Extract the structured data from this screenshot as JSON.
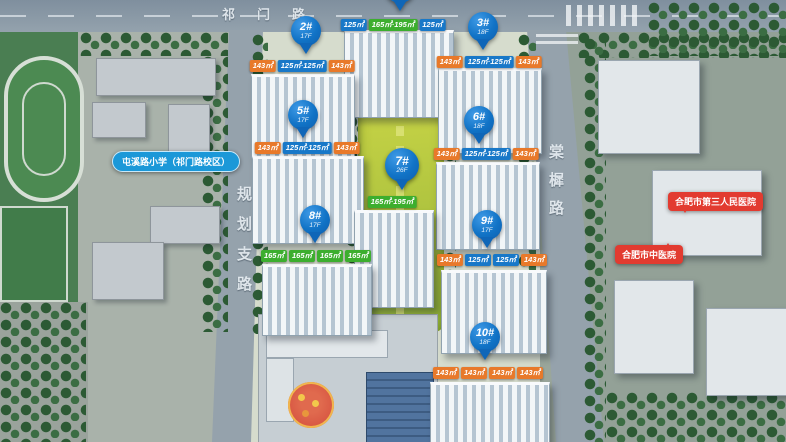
{
  "palette": {
    "pin_blue": "#1173c6",
    "tag_orange": "#e8792a",
    "tag_blue": "#1878c8",
    "tag_green": "#3cae2e",
    "poi_red": "#e23b30",
    "poi_school_blue": "#1b98d8",
    "road_gray": "#95a2ac",
    "park_green": "#aec33f"
  },
  "roads": {
    "top_label": "祁门路",
    "left_label": "规划支路",
    "right_label": "棠樨路"
  },
  "pois": {
    "school": "屯溪路小学（祁门路校区）",
    "hospital_third": "合肥市第三人民医院",
    "hospital_tcm": "合肥市中医院"
  },
  "buildings": [
    {
      "id": "1#",
      "tags": [
        {
          "color": "blue",
          "text": "125㎡"
        },
        {
          "color": "green",
          "text": "165㎡·195㎡"
        },
        {
          "color": "blue",
          "text": "125㎡"
        }
      ]
    },
    {
      "id": "2#",
      "pin": {
        "label": "2#",
        "sub": "17F"
      },
      "tags": [
        {
          "color": "orange",
          "text": "143㎡"
        },
        {
          "color": "blue",
          "text": "125㎡·125㎡"
        },
        {
          "color": "orange",
          "text": "143㎡"
        }
      ]
    },
    {
      "id": "3#",
      "pin": {
        "label": "3#",
        "sub": "18F"
      },
      "tags": [
        {
          "color": "orange",
          "text": "143㎡"
        },
        {
          "color": "blue",
          "text": "125㎡·125㎡"
        },
        {
          "color": "orange",
          "text": "143㎡"
        }
      ]
    },
    {
      "id": "5#",
      "pin": {
        "label": "5#",
        "sub": "17F"
      },
      "tags": [
        {
          "color": "orange",
          "text": "143㎡"
        },
        {
          "color": "blue",
          "text": "125㎡·125㎡"
        },
        {
          "color": "orange",
          "text": "143㎡"
        }
      ]
    },
    {
      "id": "6#",
      "pin": {
        "label": "6#",
        "sub": "18F"
      },
      "tags": [
        {
          "color": "orange",
          "text": "143㎡"
        },
        {
          "color": "blue",
          "text": "125㎡·125㎡"
        },
        {
          "color": "orange",
          "text": "143㎡"
        }
      ]
    },
    {
      "id": "7#",
      "pin": {
        "label": "7#",
        "sub": "26F"
      },
      "tags": [
        {
          "color": "green",
          "text": "165㎡·195㎡"
        }
      ]
    },
    {
      "id": "8#",
      "pin": {
        "label": "8#",
        "sub": "17F"
      },
      "tags": [
        {
          "color": "green",
          "text": "165㎡"
        },
        {
          "color": "green",
          "text": "165㎡"
        },
        {
          "color": "green",
          "text": "165㎡"
        },
        {
          "color": "green",
          "text": "165㎡"
        }
      ]
    },
    {
      "id": "9#",
      "pin": {
        "label": "9#",
        "sub": "17F"
      },
      "tags": [
        {
          "color": "orange",
          "text": "143㎡"
        },
        {
          "color": "blue",
          "text": "125㎡"
        },
        {
          "color": "blue",
          "text": "125㎡"
        },
        {
          "color": "orange",
          "text": "143㎡"
        }
      ]
    },
    {
      "id": "10#",
      "pin": {
        "label": "10#",
        "sub": "18F"
      },
      "tags": [
        {
          "color": "orange",
          "text": "143㎡"
        },
        {
          "color": "orange",
          "text": "143㎡"
        },
        {
          "color": "orange",
          "text": "143㎡"
        },
        {
          "color": "orange",
          "text": "143㎡"
        }
      ]
    }
  ]
}
